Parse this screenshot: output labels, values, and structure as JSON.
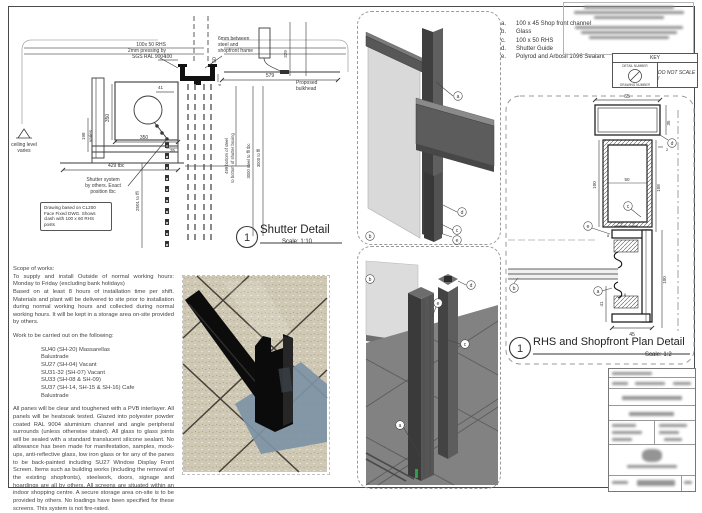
{
  "shutter_detail": {
    "number": "1",
    "title": "Shutter Detail",
    "scale": "Scale: 1:10",
    "labels": {
      "rhs": "100x 50 RHS\n2mm pressing by\nSGS RAL 9004",
      "gap": "6mm between\nsteel and\nshopfront frame",
      "bulkhead": "Proposed\nbulkhead",
      "ceiling": "ceiling level\nvaries",
      "shutter_system": "Shutter system\nby others. Exact\nposition tbc",
      "note_box": "Drawing based on CL200\nFace Fixed DWG. Shows\nclash with 100 x 60 RHS\nposts"
    },
    "dims": {
      "d100": "100",
      "d50": "50",
      "d6": "6",
      "d41": "41",
      "d350v": "350",
      "d350h": "350",
      "d35": "35",
      "d198a": "198",
      "d198b": "varies",
      "d429": "429 tbc",
      "d579": "579",
      "d329": "329",
      "d2501": "2501 to ffl",
      "d499a": "499 bottom of steel",
      "d499b": "to bottom of shutter boxing",
      "d3000a": "3000 steel to ffl tbc",
      "d3000b": "3000 to ffl"
    }
  },
  "plan_detail": {
    "number": "1",
    "title": "RHS and Shopfront Plan Detail",
    "scale": "Scale: 1:2",
    "dims": {
      "d65": "65",
      "d35": "35",
      "d2": "2",
      "d100l": "100",
      "d50": "50",
      "d108": "108",
      "d13": "13",
      "d9": "9",
      "d8": "8",
      "d41": "41",
      "d6": "6",
      "d45": "45",
      "d100r": "100"
    }
  },
  "tags": {
    "a": "a",
    "b": "b",
    "c": "c",
    "d": "d",
    "e": "e"
  },
  "notes": {
    "items": [
      {
        "key": "a.",
        "text": "100 x 45 Shop front channel"
      },
      {
        "key": "b.",
        "text": "Glass"
      },
      {
        "key": "c.",
        "text": "100 x 50 RHS"
      },
      {
        "key": "d.",
        "text": "Shutter Guide"
      },
      {
        "key": "e.",
        "text": "Polyrod and Arbosil 1096 Sealant"
      }
    ]
  },
  "key_box": {
    "title": "KEY",
    "detail_label": "DETAIL NUMBER",
    "drawing_label": "DRAWING NUMBER",
    "do_not_scale": "DO NOT SCALE !"
  },
  "scope": {
    "heading": "Scope of works:",
    "para1": "To supply and install Outside of normal working hours: Monday to Friday (excluding bank holidays)\nBased on at least 8 hours of installation time per shift. Materials and plant will be delivered to site prior to installation during normal working hours and collected during normal working hours. It will be kept in a storage area on-site provided by others.",
    "work_heading": "Work to be carried out on the following:",
    "units": [
      "SU40 (SH-20) Massarellas",
      "Balustrade",
      "SU27 (SH-04) Vacant",
      "SU31-32 (SH-07) Vacant",
      "SU33 (SH-08 & SH-09)",
      "SU37 (SH-14, SH-15 & SH-16) Cafe",
      "Balustrade"
    ],
    "para2": "All panes will be clear and toughened with a PVB interlayer. All panels will be heatsoak tested. Glazed into polyester powder coated RAL 9004 aluminium channel and angle peripheral surrounds (unless otherwise stated). All glass to glass joints will be sealed with a standard translucent silicone sealant. No allowance has been made for manifestation, samples, mock-ups, anti-reflective glass, low iron glass or for any of the panes to be back-painted including SU27 Window Display Front Screen. Items such as building works (including the removal of the existing shopfronts), steelwork, doors, signage and hoardings are all by others. All screens are situated within an indoor shopping centre. A secure storage area on-site is to be provided by others. No loadings have been specified for these screens. This system is not fire-rated."
  },
  "colors": {
    "line": "#3a3a3a",
    "steel_dark": "#3f3f3f",
    "steel_mid": "#5c5c5c",
    "glass": "#d9d9d9",
    "shadow_blue": "#7d93a6",
    "tile_beige": "#cfc8b4"
  }
}
